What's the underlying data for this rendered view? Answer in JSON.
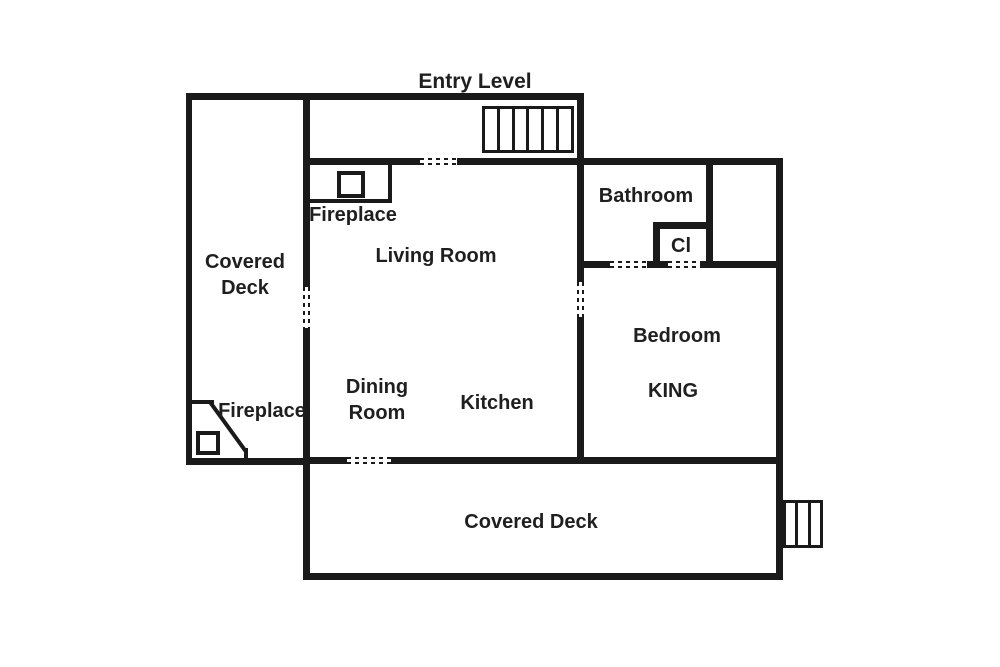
{
  "title": "Entry Level",
  "labels": {
    "covered_deck_left": "Covered Deck",
    "fireplace_living": "Fireplace",
    "living_room": "Living Room",
    "bathroom": "Bathroom",
    "closet": "Cl",
    "bedroom": "Bedroom",
    "bed_size": "KING",
    "dining_room": "Dining Room",
    "kitchen": "Kitchen",
    "fireplace_deck": "Fireplace",
    "covered_deck_bottom": "Covered Deck"
  },
  "stairs": {
    "entry_treads": 6,
    "deck_treads": 3
  },
  "colors": {
    "wall": "#1a1a1a",
    "text": "#1f1f1f",
    "background": "#ffffff"
  }
}
